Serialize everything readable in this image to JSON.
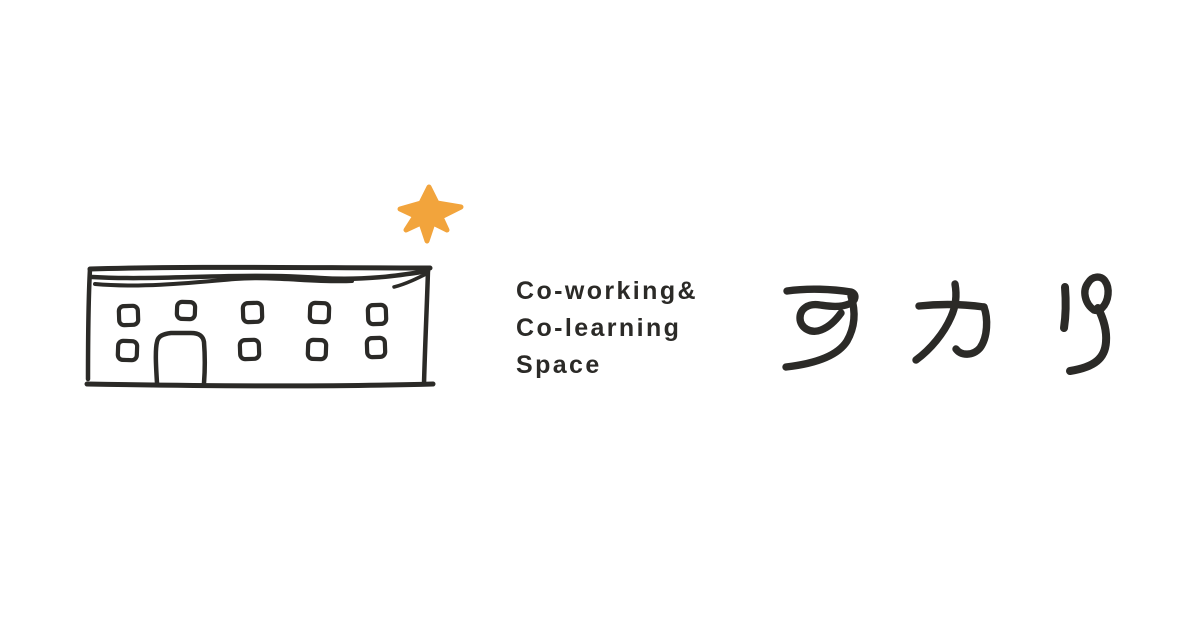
{
  "colors": {
    "background": "#ffffff",
    "ink": "#2b2a27",
    "star": "#f2a43c"
  },
  "tagline": {
    "line1": "Co-working&",
    "line2": "Co-learning",
    "line3": "Space"
  },
  "brand": {
    "name": "アカリ"
  },
  "icons": {
    "building": "hand-drawn-building-icon",
    "star": "sparkle-star-icon"
  }
}
